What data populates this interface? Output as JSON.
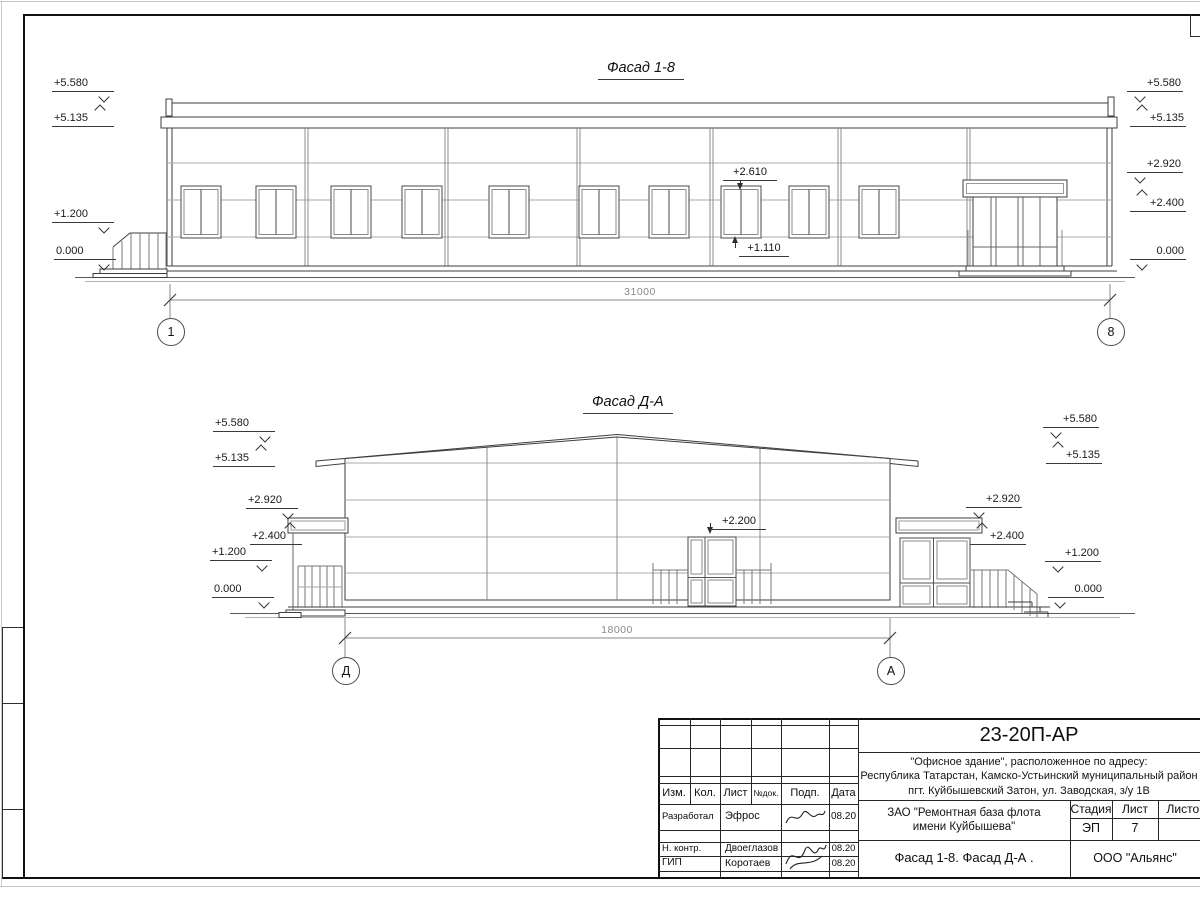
{
  "sheet": {
    "facade1": {
      "title": "Фасад 1-8",
      "dim": "31000",
      "axis_left": "1",
      "axis_right": "8",
      "marks_left": [
        "+5.580",
        "+5.135",
        "+1.200",
        "0.000"
      ],
      "marks_right": [
        "+5.580",
        "+5.135",
        "+2.920",
        "+2.400",
        "0.000"
      ],
      "ann_window_top": "+2.610",
      "ann_window_sill": "+1.110"
    },
    "facade2": {
      "title": "Фасад Д-А",
      "dim": "18000",
      "axis_left": "Д",
      "axis_right": "А",
      "marks_left": [
        "+5.580",
        "+5.135",
        "+2.920",
        "+2.400",
        "+1.200",
        "0.000"
      ],
      "marks_right": [
        "+5.580",
        "+5.135",
        "+2.920",
        "+2.400",
        "+1.200",
        "0.000"
      ],
      "ann_door_top": "+2.200"
    },
    "titleblock": {
      "doc_number": "23-20П-АР",
      "address_line1": "\"Офисное здание\", расположенное по адресу:",
      "address_line2": "Республика Татарстан, Камско-Устьинский муниципальный район",
      "address_line3": "пгт. Куйбышевский Затон, ул. Заводская, з/у 1В",
      "client_line1": "ЗАО \"Ремонтная база флота",
      "client_line2": "имени Куйбышева\"",
      "sheet_title": "Фасад 1-8. Фасад Д-А .",
      "company": "ООО \"Альянс\"",
      "stage_label": "Стадия",
      "sheet_label": "Лист",
      "sheets_label": "Листов",
      "stage_value": "ЭП",
      "sheet_value": "7",
      "header_cols": [
        "Изм.",
        "Кол.",
        "Лист",
        "№док.",
        "Подп.",
        "Дата"
      ],
      "rows": [
        {
          "role": "Разработал",
          "name": "Эфрос",
          "date": "08.20"
        },
        {
          "role": "Н. контр.",
          "name": "Двоеглазов",
          "date": "08.20"
        },
        {
          "role": "ГИП",
          "name": "Коротаев",
          "date": "08.20"
        }
      ]
    }
  }
}
